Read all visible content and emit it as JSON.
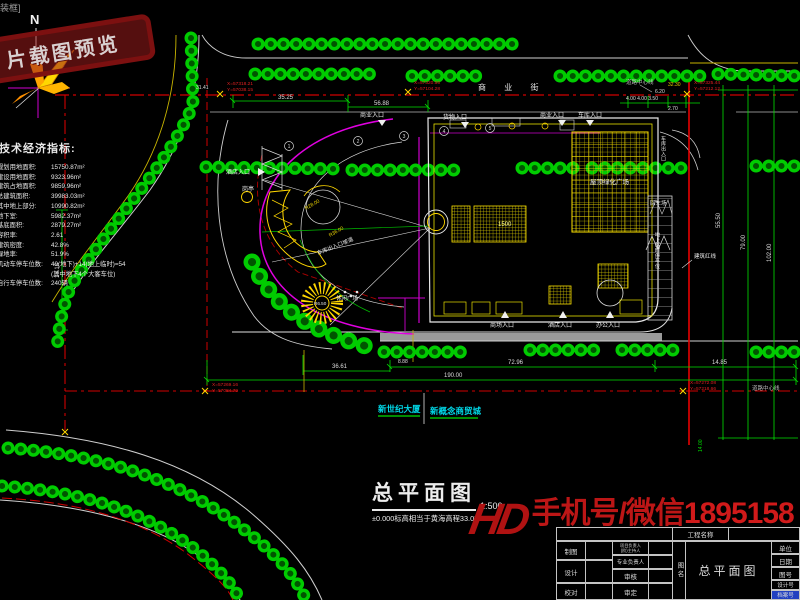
{
  "window": {
    "corner_text": "装框]"
  },
  "stamp": {
    "text": "片载图预览"
  },
  "compass": {
    "label": "N"
  },
  "indicators": {
    "title": "技术经济指标:",
    "rows": [
      {
        "label": "规划用地面积:",
        "value": "15750.87m²"
      },
      {
        "label": "建设用地面积:",
        "value": "9323.96m²"
      },
      {
        "label": "建筑占地面积:",
        "value": "9859.96m²"
      },
      {
        "label": "总建筑面积:",
        "value": "39983.03m²"
      },
      {
        "label": "其中地上部分:",
        "value": "10990.82m²"
      },
      {
        "label": "地下室:",
        "value": "5982.37m²"
      },
      {
        "label": "基底面积:",
        "value": "2879.27m²"
      },
      {
        "label": "容积率:",
        "value": "2.61"
      },
      {
        "label": "建筑密度:",
        "value": "42.8%"
      },
      {
        "label": "绿地率:",
        "value": "51.9%"
      },
      {
        "label": "机动车停车位数:",
        "value": "40(地下)+14(地上临时)=54"
      },
      {
        "label": "",
        "value": "(其中地下4个大客车位)"
      },
      {
        "label": "自行车停车位数:",
        "value": "240辆"
      }
    ]
  },
  "streets": {
    "name": "商 业 街",
    "road_center": "道路中心线",
    "red_line": "建筑红线"
  },
  "entrances": {
    "biz": "商业入口",
    "goods": "货物入口",
    "garage": "车库入口",
    "mall": "商场入口",
    "hotel": "酒店入口",
    "office": "办公入口"
  },
  "features": {
    "guard": "岗亭",
    "ramp": "车库出入口坡道",
    "plaza": "休闲广场",
    "turnaround": "回车场",
    "roof": "屋顶绿化广场",
    "parking_v": "地上临时停车位",
    "garage_v": "车库出入口",
    "r36": "R36.00",
    "r28": "R28.00",
    "fountain_r": "R6.50"
  },
  "dims": {
    "d35": "35.25",
    "d56": "56.88",
    "d620": "6.20",
    "d4433": "4.00 4.00 3.50",
    "d270": "2.70",
    "d3230": "32.30",
    "d5550": "55.50",
    "d79": "79.00",
    "d102": "102.00",
    "d7296": "72.96",
    "d1485": "14.85",
    "d190": "190.00",
    "d3661": "36.61",
    "d1518": "15.18",
    "d3141": "31.41",
    "d888": "8.88",
    "d14": "14.00",
    "d1500": "1500"
  },
  "coords": {
    "c1x": "X=57318.21",
    "c1y": "Y=57038.15",
    "c2x": "X=57320.55",
    "c2y": "Y=57104.28",
    "c3x": "X=57325.44",
    "c3y": "Y=57212.12",
    "c4x": "X=57269.16",
    "c4y": "Y=57084.79",
    "c5x": "X=57272.08",
    "c5y": "Y=57218.66"
  },
  "bubbles": [
    "1",
    "2",
    "3",
    "4",
    "5"
  ],
  "buildings": {
    "b1": "新世纪大厦",
    "b2": "新概念商贸城"
  },
  "title_area": {
    "title": "总平面图",
    "scale": "1:500",
    "note": "±0.000标高相当于黄海高程33.05"
  },
  "watermark": {
    "logo": "HD",
    "prefix": "手机号/微信",
    "number": "18951580"
  },
  "titleblock": {
    "project_label": "工程名称",
    "draw": "制图",
    "design": "设计",
    "proof": "校对",
    "lead1a": "项目负责人",
    "lead1b": "(阶)主持人",
    "lead2": "专业负责人",
    "review": "审核",
    "approve": "审定",
    "name_label": "图名",
    "drawing_name": "总平面图",
    "unit": "单位",
    "date": "日期",
    "fig_no": "图号",
    "design_no": "设计号",
    "archive_no": "档案号"
  },
  "colors": {
    "tree_green": "#00cc00",
    "dim_green": "#00e000",
    "red_line": "#d00000",
    "magenta": "#e000e0",
    "cad_yellow": "#f0e000",
    "cyan_label": "#00d8e8",
    "watermark_red": "#bc1616"
  }
}
